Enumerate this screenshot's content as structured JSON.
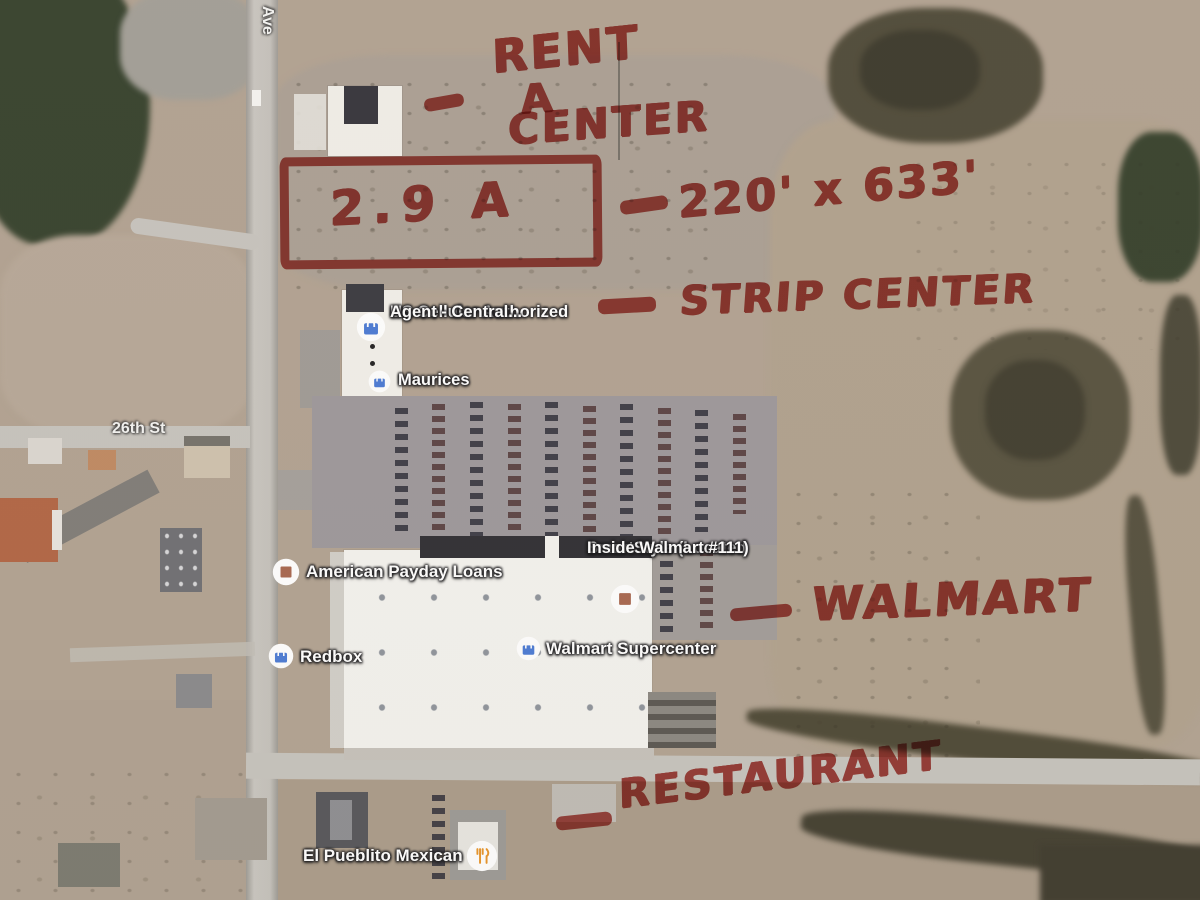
{
  "map": {
    "road_labels": {
      "ave": "Ave",
      "street_26th": "26th St"
    },
    "pois": {
      "us_cellular": {
        "line1": "US Cellular Authorized",
        "line2": "Agent - Central...",
        "icon": "shopping-bag"
      },
      "maurices": {
        "label": "Maurices",
        "icon": "shopping-bag"
      },
      "american_payday_loans": {
        "label": "American Payday Loans",
        "icon": "store"
      },
      "smartstyle": {
        "line1": "SmartStyle (Located",
        "line2": "Inside Walmart #111)",
        "icon": "store"
      },
      "redbox": {
        "label": "Redbox",
        "icon": "shopping-bag"
      },
      "walmart_supercenter": {
        "label": "Walmart Supercenter",
        "icon": "shopping-bag"
      },
      "el_pueblito": {
        "label": "El Pueblito Mexican",
        "icon": "restaurant"
      }
    },
    "icon_colors": {
      "shopping_bag_blue": "#4b7bd5",
      "store_brown": "#a8674f",
      "restaurant_orange": "#e8952a"
    }
  },
  "annotations": {
    "ink_color": "#b1302a",
    "rent_a_center": {
      "line1": "RENT",
      "line2": "A",
      "line3": "CENTER"
    },
    "parcel": {
      "area_label": "2.9 A",
      "dimensions": "220' x 633'"
    },
    "strip_center": "STRIP CENTER",
    "walmart": "WALMART",
    "restaurant": "RESTAURANT"
  }
}
